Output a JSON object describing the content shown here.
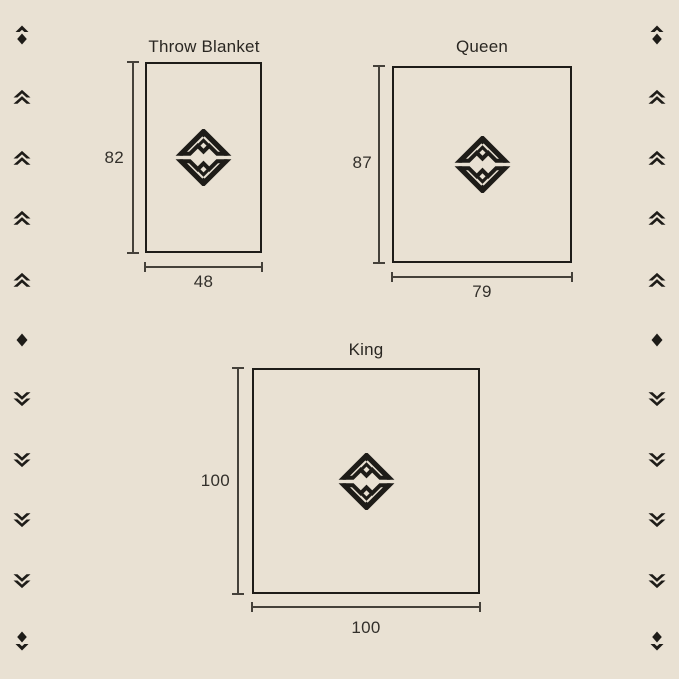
{
  "colors": {
    "background": "#e9e1d3",
    "ink": "#1e1c18",
    "dimension_line": "#45413a",
    "text": "#2a2722"
  },
  "diagrams": [
    {
      "title": "Throw Blanket",
      "height_label": "82",
      "width_label": "48"
    },
    {
      "title": "Queen",
      "height_label": "87",
      "width_label": "79"
    },
    {
      "title": "King",
      "height_label": "100",
      "width_label": "100"
    }
  ],
  "emblem_icon": "brand-diamond-emblem",
  "ornaments": {
    "left": [
      "chevron-up-diamond",
      "double-chevron-up",
      "double-chevron-up",
      "double-chevron-up",
      "double-chevron-up",
      "diamond",
      "double-chevron-down",
      "double-chevron-down",
      "double-chevron-down",
      "double-chevron-down",
      "diamond-chevron-down"
    ],
    "right": [
      "chevron-up-diamond",
      "double-chevron-up",
      "double-chevron-up",
      "double-chevron-up",
      "double-chevron-up",
      "diamond",
      "double-chevron-down",
      "double-chevron-down",
      "double-chevron-down",
      "double-chevron-down",
      "diamond-chevron-down"
    ]
  }
}
